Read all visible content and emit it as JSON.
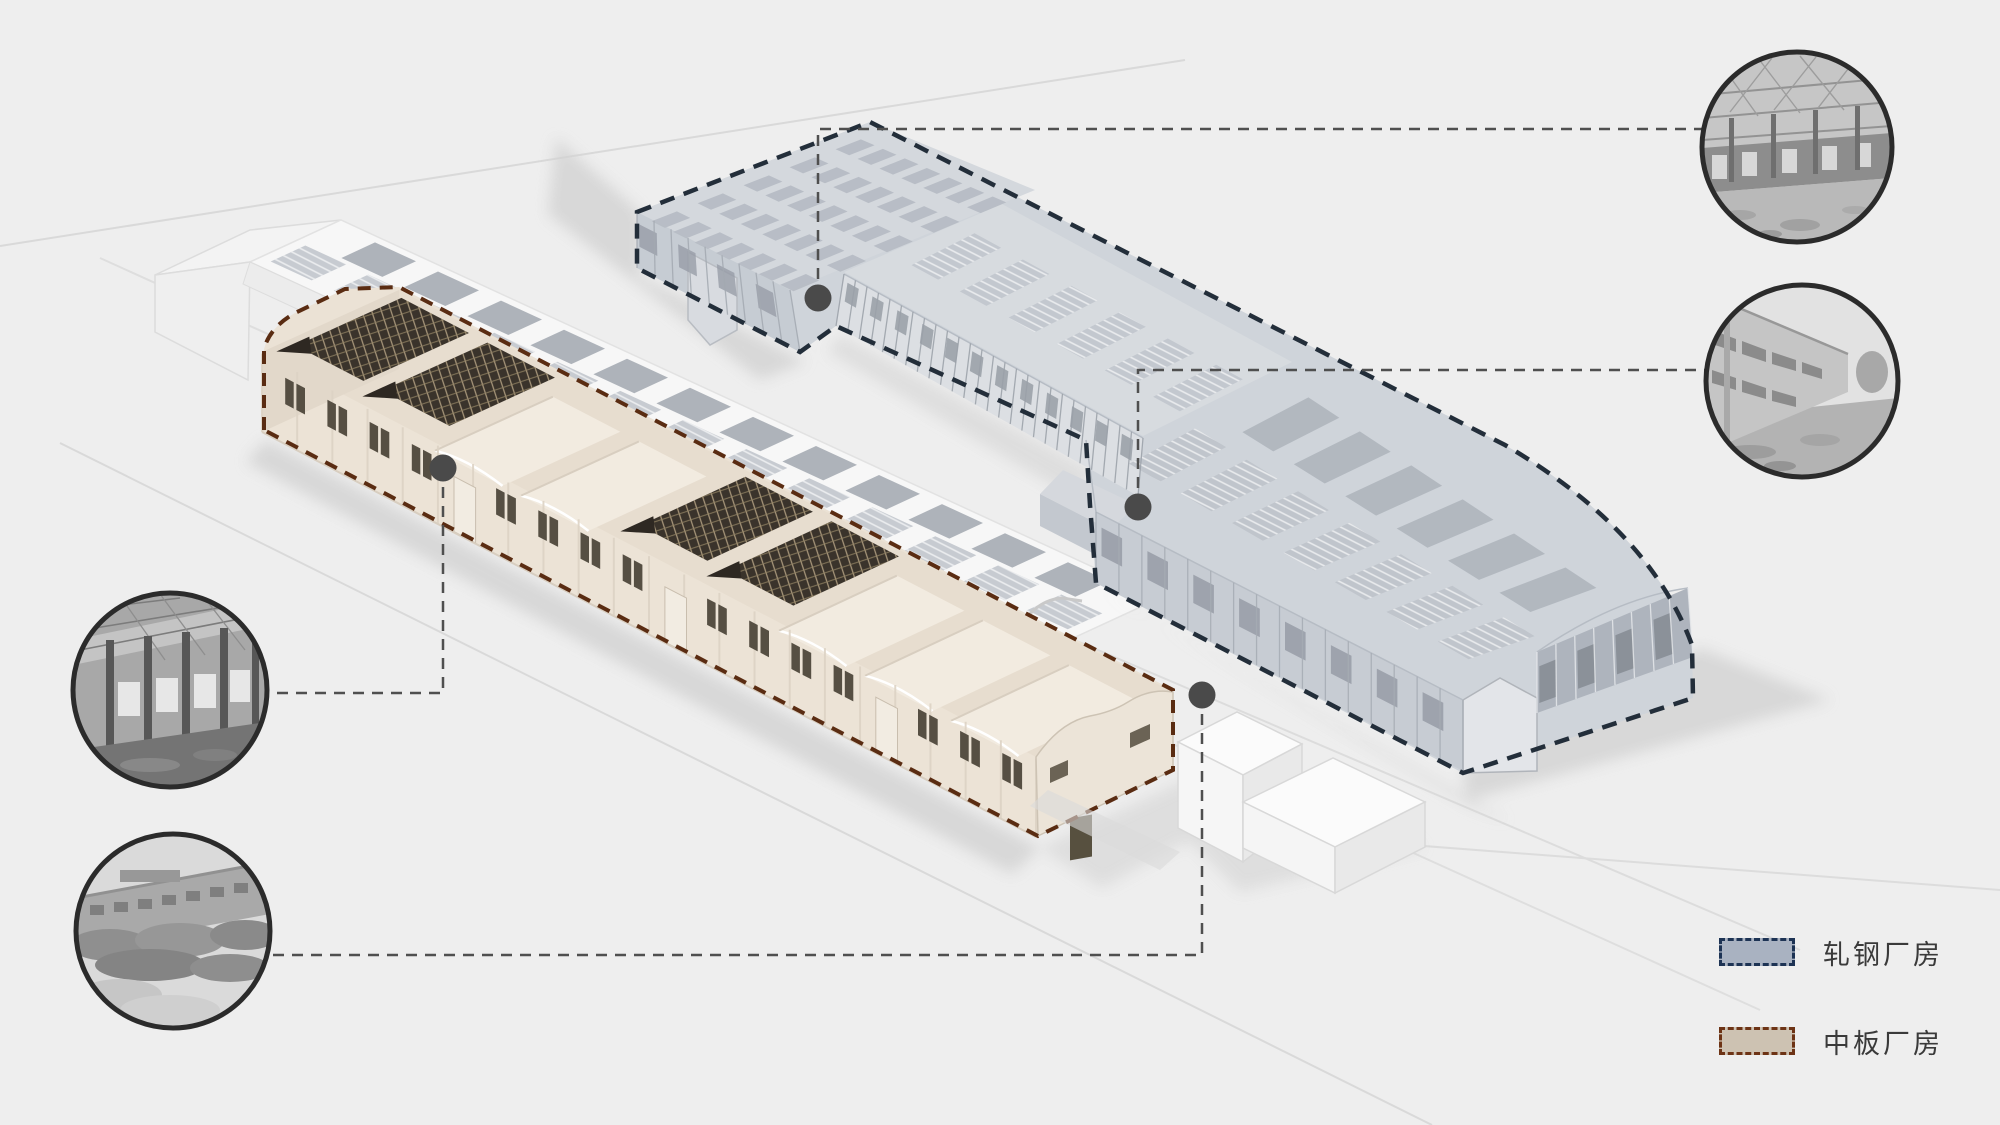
{
  "scene": {
    "background": "#eeeeee",
    "description": "axonometric factory site diagram with two highlighted industrial halls and four photo callouts"
  },
  "legend": {
    "items": [
      {
        "id": "rolling-mill",
        "label": "轧钢厂房",
        "fill": "#a9b2c1",
        "border": "#1d3354"
      },
      {
        "id": "plate-mill",
        "label": "中板厂房",
        "fill": "#cdc2b2",
        "border": "#6d3315"
      }
    ]
  },
  "buildings": [
    {
      "id": "rolling-mill-hall",
      "label": "轧钢厂房",
      "accent": "#232e3a",
      "body": "#cfd4da"
    },
    {
      "id": "plate-mill-hall",
      "label": "中板厂房",
      "accent": "#5a2c12",
      "body": "#ece3d6"
    },
    {
      "id": "background-shed",
      "label": "",
      "accent": "#dcdcdc",
      "body": "#f6f6f6"
    }
  ],
  "photos": [
    {
      "id": "photo-top-right",
      "name": "interior-truss-hall-photo",
      "links_to": "rolling-mill-hall"
    },
    {
      "id": "photo-right",
      "name": "exterior-facade-photo",
      "links_to": "rolling-mill-hall"
    },
    {
      "id": "photo-left-upper",
      "name": "interior-columns-photo",
      "links_to": "plate-mill-hall"
    },
    {
      "id": "photo-left-lower",
      "name": "exterior-overgrown-photo",
      "links_to": "plate-mill-hall"
    }
  ]
}
